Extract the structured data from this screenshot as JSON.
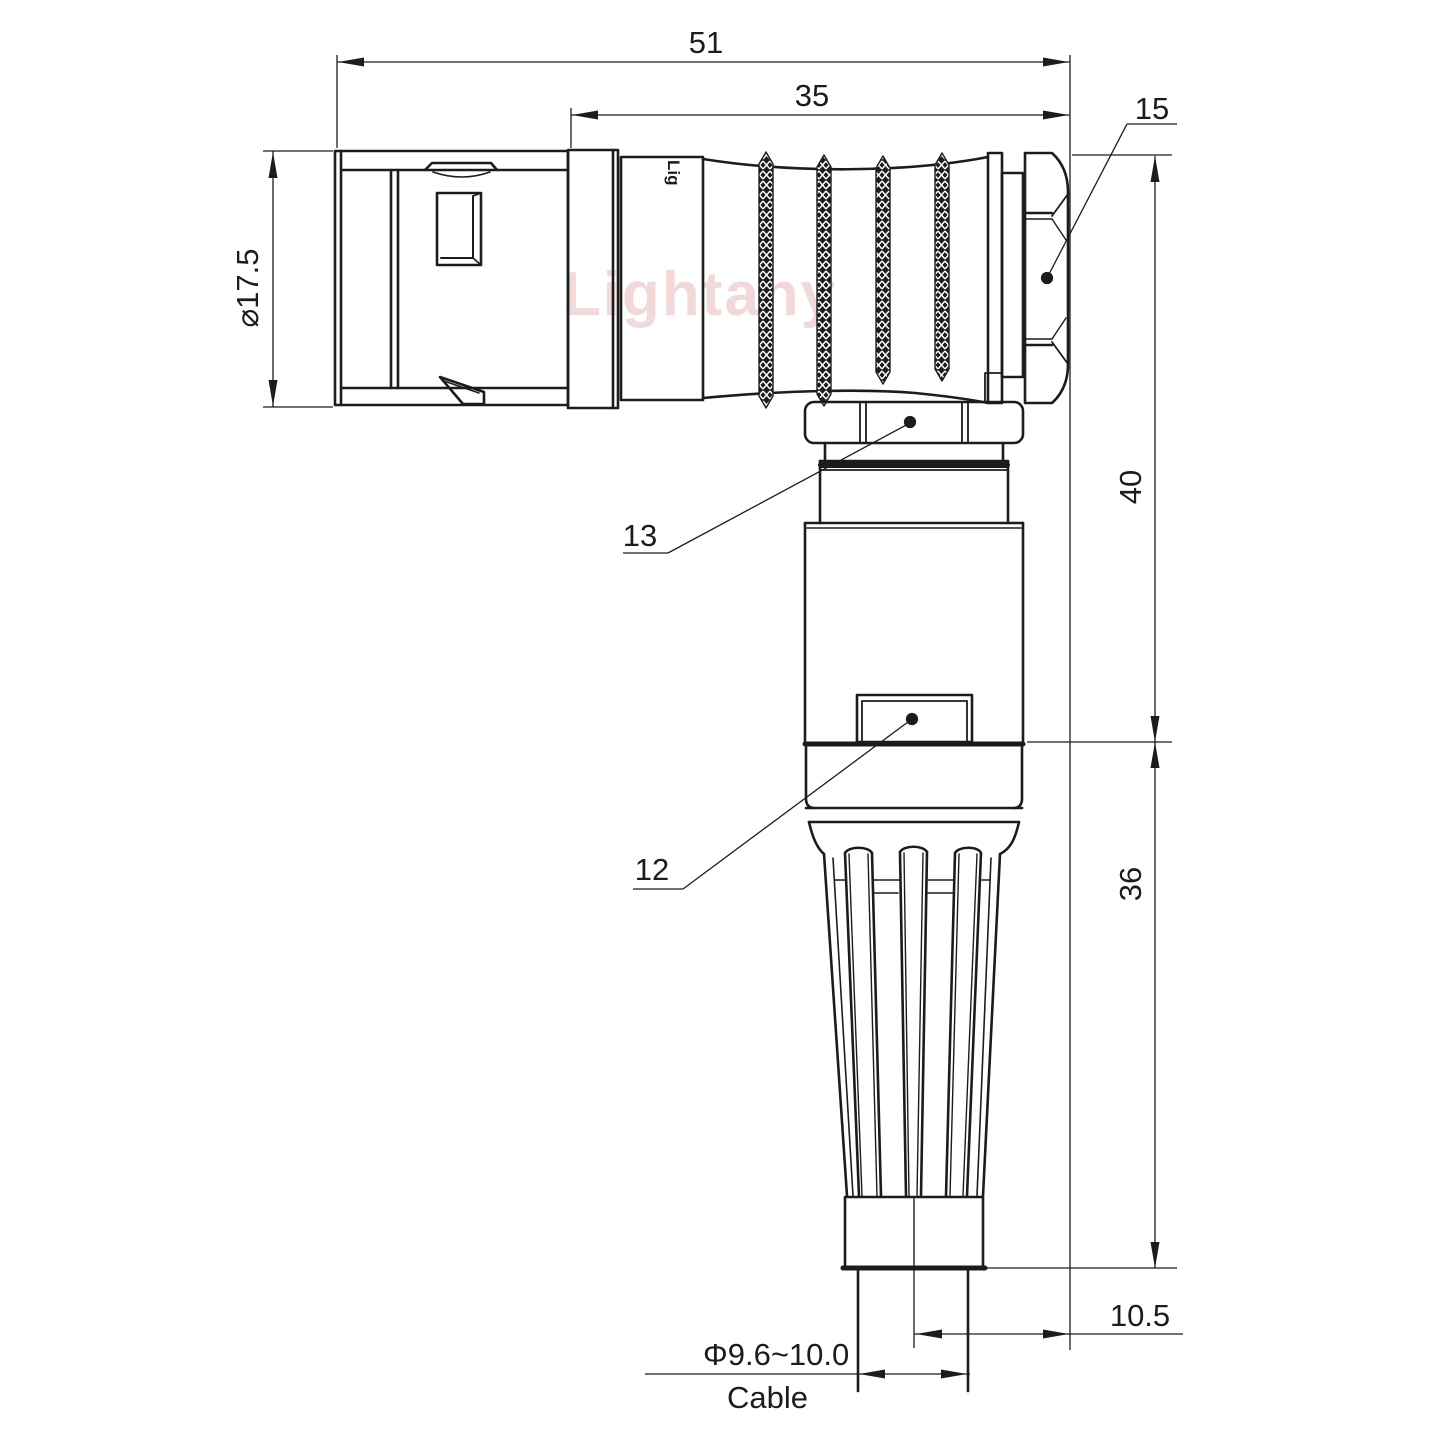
{
  "drawing": {
    "watermark": "Lightany",
    "logo_marking": "Lig",
    "dimensions": {
      "overall_length": "51",
      "grip_length": "35",
      "hex_nut": "15",
      "front_diameter": "⌀17.5",
      "height_upper": "40",
      "height_lower": "36",
      "cable_offset": "10.5",
      "cable_diameter": "Φ9.6~10.0",
      "cable_label": "Cable",
      "part_upper": "13",
      "part_lower": "12"
    },
    "colors": {
      "line": "#1c1c1c",
      "watermark": "#d98c8c",
      "background": "#ffffff"
    }
  }
}
